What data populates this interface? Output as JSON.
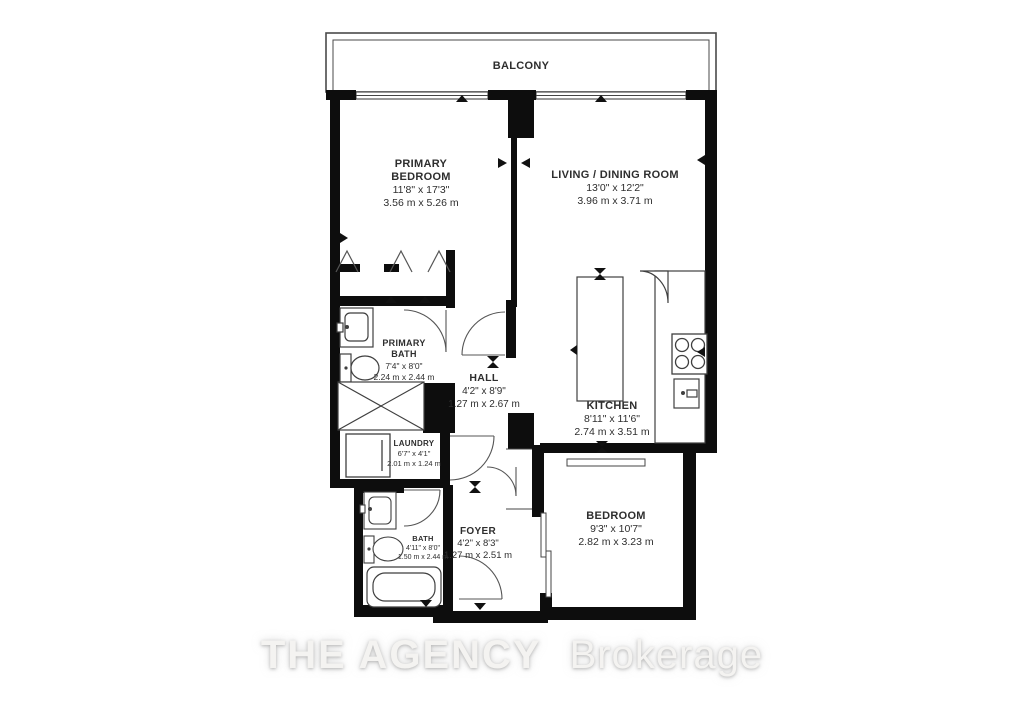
{
  "balcony": {
    "label": "BALCONY"
  },
  "rooms": {
    "primary_bedroom": {
      "name_line1": "PRIMARY",
      "name_line2": "BEDROOM",
      "imperial": "11'8\" x 17'3\"",
      "metric": "3.56 m x 5.26 m"
    },
    "living_dining": {
      "name": "LIVING / DINING ROOM",
      "imperial": "13'0\" x 12'2\"",
      "metric": "3.96 m x 3.71 m"
    },
    "primary_bath": {
      "name_line1": "PRIMARY",
      "name_line2": "BATH",
      "imperial": "7'4\" x 8'0\"",
      "metric": "2.24 m x 2.44 m"
    },
    "hall": {
      "name": "HALL",
      "imperial": "4'2\" x 8'9\"",
      "metric": "1.27 m x 2.67 m"
    },
    "kitchen": {
      "name": "KITCHEN",
      "imperial": "8'11\" x 11'6\"",
      "metric": "2.74 m x 3.51 m"
    },
    "laundry": {
      "name": "LAUNDRY",
      "imperial": "6'7\" x 4'1\"",
      "metric": "2.01 m x 1.24 m"
    },
    "bath": {
      "name": "BATH",
      "imperial": "4'11\" x 8'0\"",
      "metric": "1.50 m x 2.44 m"
    },
    "foyer": {
      "name": "FOYER",
      "imperial": "4'2\" x 8'3\"",
      "metric": "1.27 m x 2.51 m"
    },
    "bedroom": {
      "name": "BEDROOM",
      "imperial": "9'3\" x 10'7\"",
      "metric": "2.82 m x 3.23 m"
    }
  },
  "watermark": {
    "brand": "THE AGENCY",
    "suffix": "Brokerage"
  },
  "colors": {
    "wall": "#0d0d0d",
    "line": "#3f3f3f",
    "text": "#2e2e2e",
    "watermark": "#f4f3f1"
  }
}
